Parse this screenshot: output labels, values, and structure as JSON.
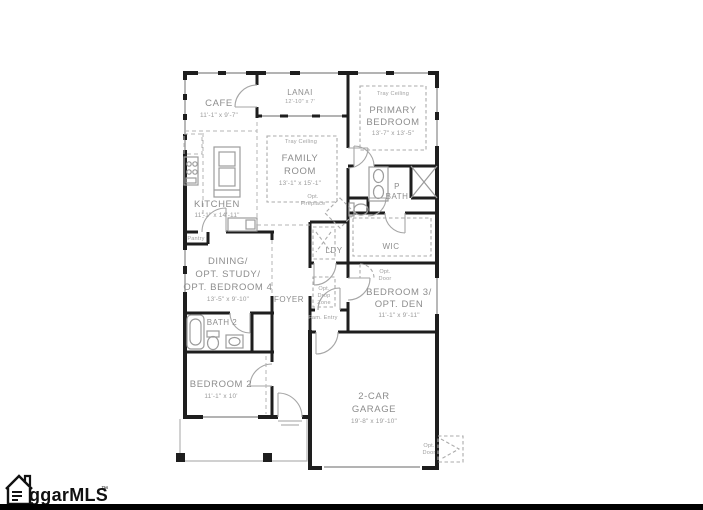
{
  "colors": {
    "wall": "#1e1e1e",
    "label": "#8d8d8d",
    "background": "#ffffff"
  },
  "labels": {
    "cafe_name": "CAFE",
    "cafe_dims": "11'-1\" x 9'-7\"",
    "lanai_name": "LANAI",
    "lanai_dims": "12'-10\" x 7'",
    "tray_ceiling": "Tray Ceiling",
    "primary_1": "PRIMARY",
    "primary_2": "BEDROOM",
    "primary_dims": "13'-7\" x 13'-5\"",
    "family_1": "FAMILY",
    "family_2": "ROOM",
    "family_dims": "13'-1\" x 15'-1\"",
    "opt_fireplace_1": "Opt.",
    "opt_fireplace_2": "Fireplace",
    "kitchen_name": "KITCHEN",
    "kitchen_dims": "11'-1\" x 14'-11\"",
    "pantry": "Pantry",
    "pbath_1": "P",
    "pbath_2": "BATH",
    "wic": "WIC",
    "ldy": "LDY",
    "dining_1": "DINING/",
    "dining_2": "OPT. STUDY/",
    "dining_3": "OPT. BEDROOM 4",
    "dining_dims": "13'-5\" x 9'-10\"",
    "foyer": "FOYER",
    "drop_1": "Opt.",
    "drop_2": "Drop",
    "drop_3": "Zone",
    "fam_entry": "Fam. Entry",
    "optdoor_1": "Opt.",
    "optdoor_2": "Door",
    "bedroom3_1": "BEDROOM 3/",
    "bedroom3_2": "OPT. DEN",
    "bedroom3_dims": "11'-1\" x 9'-11\"",
    "bath2": "BATH 2",
    "bedroom2_name": "BEDROOM 2",
    "bedroom2_dims": "11'-1\" x 10'",
    "garage_1": "2-CAR",
    "garage_2": "GARAGE",
    "garage_dims": "19'-8\" x 19'-10\"",
    "optdoor_garage_1": "Opt.",
    "optdoor_garage_2": "Door"
  },
  "watermark": {
    "brand": "ggarMLS",
    "tm": "™"
  }
}
